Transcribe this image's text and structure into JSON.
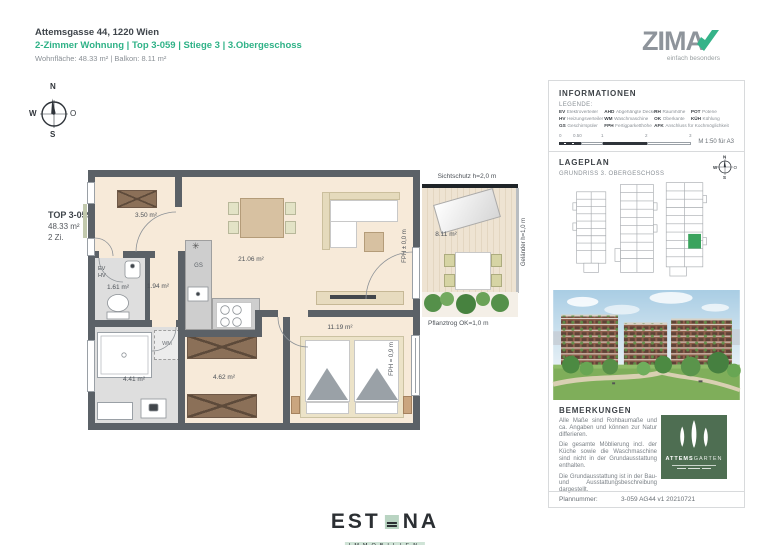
{
  "header": {
    "address": "Attemsgasse 44, 1220 Wien",
    "subtitle": "2-Zimmer Wohnung | Top 3-059 | Stiege 3 | 3.Obergeschoss",
    "areas": "Wohnfläche: 48.33 m²  |  Balkon: 8.11 m²"
  },
  "zima": {
    "wordmark": "ZIMA",
    "tagline": "einfach besonders"
  },
  "compass": {
    "n": "N",
    "e": "O",
    "s": "S",
    "w": "W"
  },
  "unit": {
    "top_no": "TOP 3-059",
    "area": "48.33 m²",
    "rooms": "2 Zi."
  },
  "plan": {
    "rooms": {
      "entry": "3.50 m²",
      "wc": "1.61 m²",
      "corridor": "1.94 m²",
      "living": "21.06 m²",
      "bath": "4.41 m²",
      "hall": "4.62 m²",
      "bedroom": "11.19 m²",
      "balcony": "8.11 m²"
    },
    "labels": {
      "ev": "EV",
      "hv": "HV",
      "gs": "GS",
      "wm": "WM",
      "sichtschutz": "Sichtschutz h=2,0 m",
      "gelaender": "Geländer h=1,0 m",
      "pflanztrog": "Pflanztrog OK=1,0 m",
      "fph_door": "FPH ± 0,0 m",
      "fph_window": "FPH = 0,9 m"
    }
  },
  "sidebar": {
    "informationen": {
      "title": "INFORMATIONEN",
      "legende": "LEGENDE:",
      "legend": [
        {
          "abbr": "EV",
          "label": "Elektroverteiler"
        },
        {
          "abbr": "AHD",
          "label": "Abgehängte Decke"
        },
        {
          "abbr": "RH",
          "label": "Raumhöhe"
        },
        {
          "abbr": "POT",
          "label": "Poterie"
        },
        {
          "abbr": "HV",
          "label": "Heizungsverteiler"
        },
        {
          "abbr": "WM",
          "label": "Waschmaschine"
        },
        {
          "abbr": "OK",
          "label": "Oberkante"
        },
        {
          "abbr": "KÜH",
          "label": "Kühlung"
        },
        {
          "abbr": "GS",
          "label": "Geschirrspüler"
        },
        {
          "abbr": "FPH",
          "label": "Fertigparketthöhe"
        },
        {
          "abbr": "AFK",
          "label": "Anschluss für Kochmöglichkeit"
        }
      ],
      "scale_ticks": [
        "0",
        "0.50",
        "1",
        "2",
        "3"
      ],
      "scale_note": "M 1:50 für A3"
    },
    "lageplan": {
      "title": "LAGEPLAN",
      "subtitle": "GRUNDRISS 3. OBERGESCHOSS"
    },
    "bemerkungen": {
      "title": "BEMERKUNGEN",
      "p1": "Alle Maße sind Rohbaumaße und ca. Angaben und können zur Natur differieren.",
      "p2": "Die gesamte Möblierung incl. der Küche sowie die Waschmaschine sind nicht in der Grundausstattung enthalten.",
      "p3": "Die Grundausstattung ist in der Bau- und Ausstattungsbeschreibung dargestellt."
    },
    "attemsgarten": {
      "brand_bold": "ATTEMS",
      "brand_light": "GARTEN"
    },
    "plannummer_label": "Plannummer:",
    "plannummer_value": "3-059 AG44 v1 20210721"
  },
  "estona": {
    "left": "EST",
    "right": "NA",
    "sub": "IMMOBILIEN"
  },
  "colors": {
    "accent_green": "#2fb287",
    "zima_gray": "#8e949b",
    "wall": "#5b6167",
    "floor": "#f7ead9",
    "floor_wet": "#dedede",
    "attems_green": "#4e6e52",
    "site_highlight": "#3aa35d"
  }
}
